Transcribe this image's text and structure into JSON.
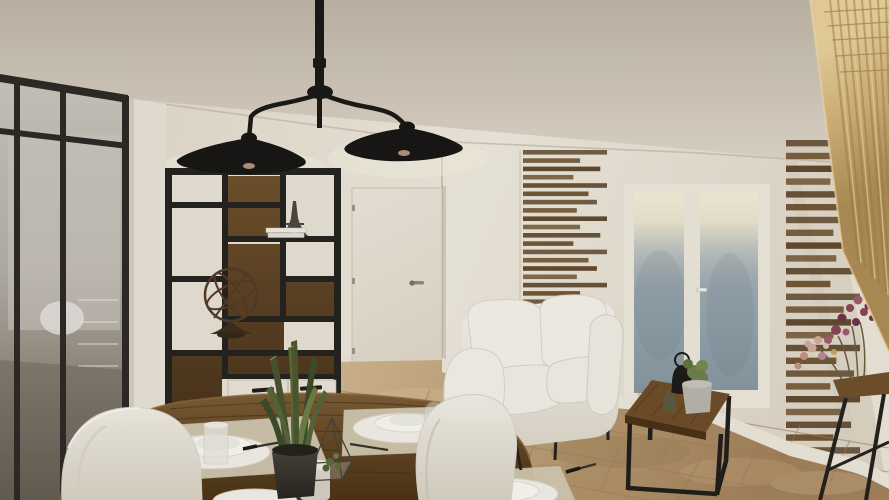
{
  "meta": {
    "kind": "3d-interior-render",
    "room": "open-plan living and dining room",
    "style": "industrial loft with glass partition, slat wall decor and travertine floor",
    "width_px": 889,
    "height_px": 500
  },
  "palette": {
    "ceil-1": "#bfb5a7",
    "ceil-2": "#ded6c9",
    "wall": "#ece6db",
    "wall-shade": "#ddd5c6",
    "wall-dark": "#c5bcab",
    "frame-black": "#2b2826",
    "steel": "#23211e",
    "glass-top": "#c9c5be",
    "glass-mid": "#b4afa6",
    "glass-low": "#675f54",
    "wood-panel-1": "#6e4f2c",
    "wood-panel-2": "#452f18",
    "drawer": "#e9e3d8",
    "door": "#ebe5da",
    "handle-metal": "#8e8a82",
    "slat-dark": "#573f24",
    "slat-light": "#6b4e2c",
    "gd-glow": "#f4edda",
    "gd-blue-1": "#9dabb5",
    "gd-blue-2": "#8795a1",
    "sofa-1": "#f6f3ed",
    "sofa-2": "#dcd6c9",
    "floor-1": "#cfb48e",
    "floor-2": "#b89a72",
    "floor-3": "#a1815a",
    "grout": "#9b7f59",
    "oak-1": "#e8d09a",
    "oak-2": "#cfae74",
    "oak-3": "#ad8c55",
    "table-1": "#7a5a33",
    "table-2": "#4a3115",
    "mat": "#d4c9b2",
    "plate": "#f3f0e9",
    "leaf-dark": "#3c4a2a",
    "leaf-light": "#6d7c44",
    "flower-purple": "#8a4458",
    "flower-pink": "#d4aa9b",
    "bulb-warm": "#c79d89",
    "chair-1": "#f3f0ea",
    "chair-2": "#d8d2c4"
  },
  "scene": {
    "objects": [
      {
        "name": "glass-partition",
        "desc": "black steel framed interior glazed wall, left side, room behind"
      },
      {
        "name": "open-shelf-unit",
        "desc": "black metal etagere with dark wood back panels and white drawers"
      },
      {
        "name": "shelf-decor",
        "items": [
          "eiffel-tower-figurine",
          "book-stack",
          "armillary-sphere"
        ]
      },
      {
        "name": "double-pendant-lamp",
        "desc": "black two-arm ceiling lamp with wide conical shades"
      },
      {
        "name": "interior-door",
        "desc": "white door in back nook with metal lever handle"
      },
      {
        "name": "slat-wall-left",
        "desc": "horizontal walnut slat decor panel"
      },
      {
        "name": "slat-wall-right",
        "desc": "horizontal walnut slat decor panel behind console"
      },
      {
        "name": "french-glass-door",
        "desc": "white frame, frosted blue-grey glass, warm light at top"
      },
      {
        "name": "white-loveseat-sofa"
      },
      {
        "name": "coffee-table",
        "desc": "square wood top, black cube frame",
        "items": [
          "black-lantern",
          "cactus-pot",
          "olive-bottle"
        ]
      },
      {
        "name": "round-dining-table",
        "desc": "rustic wood, set for dinner",
        "items": [
          "placemats",
          "plate-stacks",
          "wine-glasses",
          "tumblers",
          "cutlery",
          "glass-terrarium",
          "sansevieria-plant-pot",
          "frosted-vases"
        ]
      },
      {
        "name": "white-shell-chairs",
        "count": 2
      },
      {
        "name": "console-table",
        "desc": "black legs, wood top with dried flower bouquet"
      },
      {
        "name": "oak-stair-wall",
        "desc": "light oak plank volume in right foreground"
      },
      {
        "name": "travertine-floor"
      }
    ]
  },
  "decor": {
    "slat_cycle": [
      1,
      0.68,
      0.92,
      0.6,
      1,
      0.78,
      0.88,
      0.64
    ],
    "slat_panels": [
      {
        "id": "slats-left-g",
        "x": 523,
        "yTop": 150,
        "count": 22,
        "pitch": 8.3,
        "height": 4.6,
        "maxW": 84
      },
      {
        "id": "slats-right-g",
        "x": 786,
        "yTop": 140,
        "count": 26,
        "pitch": 12.8,
        "height": 6.4,
        "maxW": 74
      }
    ]
  }
}
